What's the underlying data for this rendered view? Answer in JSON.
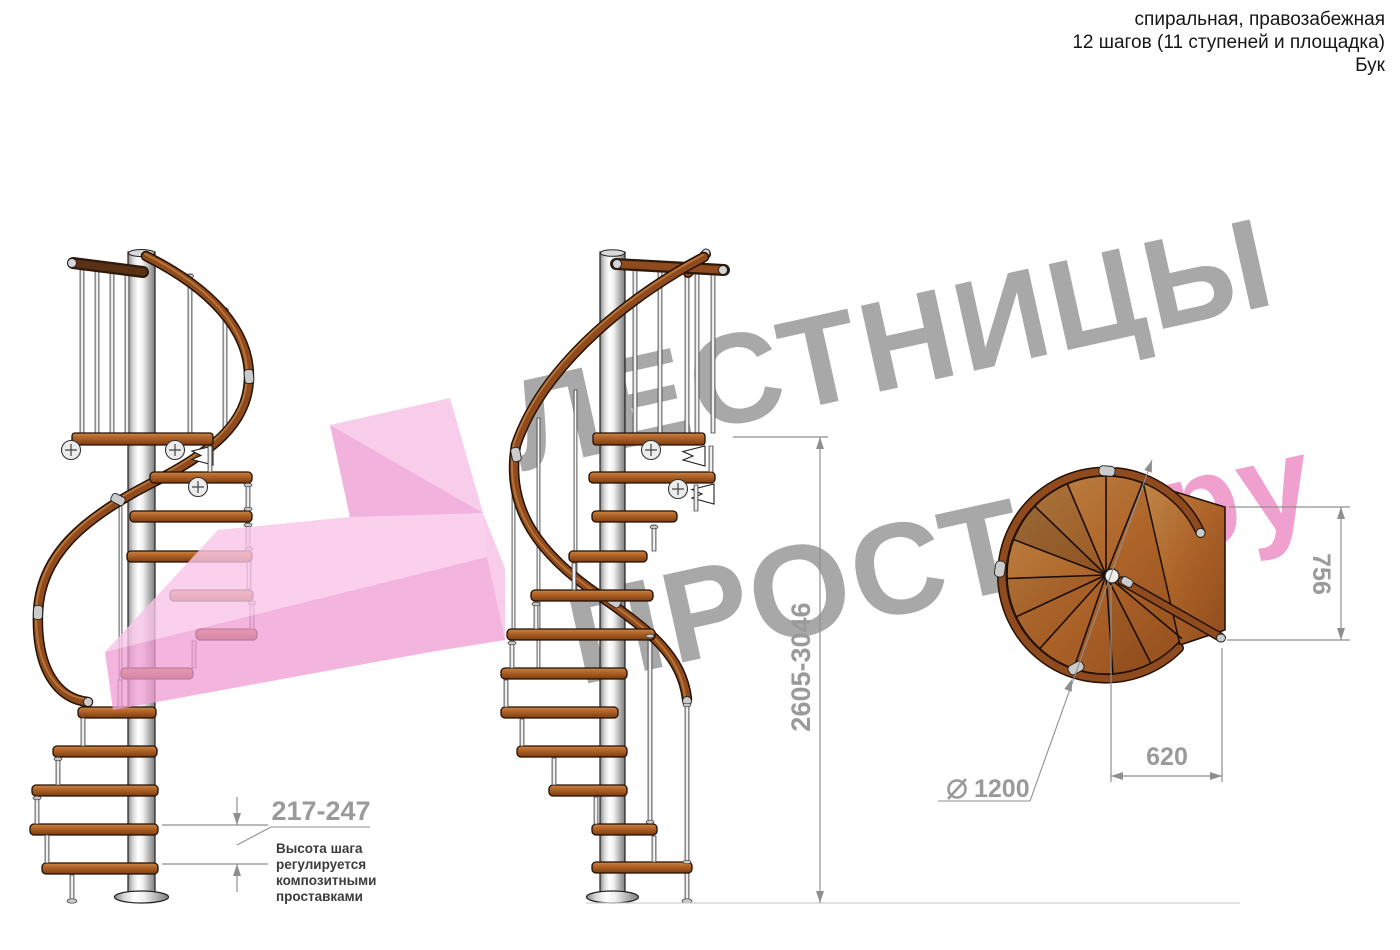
{
  "spec": {
    "type_line": "спиральная, правозабежная",
    "steps_line": "12 шагов (11 ступеней и площадка)",
    "material_line": "Бук"
  },
  "watermark": {
    "word1": "ЛЕСТНИЦЫ",
    "word2": "ПРОСТО",
    "dot": ".",
    "suffix": "ру"
  },
  "dimensions": {
    "total_height": "2605-3046",
    "step_height": "217-247",
    "platform_depth": "756",
    "platform_width": "620",
    "diameter_symbol": "⌀",
    "diameter_value": "1200"
  },
  "annotation": {
    "line1": "Высота шага",
    "line2": "регулируется",
    "line3": "композитными",
    "line4": "проставками"
  },
  "colors": {
    "wood": "#a85a24",
    "dark_wood": "#4a2810",
    "metal": "#d9d9d9",
    "dim_gray": "#9a9a9a",
    "watermark_gray": "#a8a8a8",
    "brand_pink": "#f2a9d9",
    "brand_dot": "#cb4b74"
  }
}
